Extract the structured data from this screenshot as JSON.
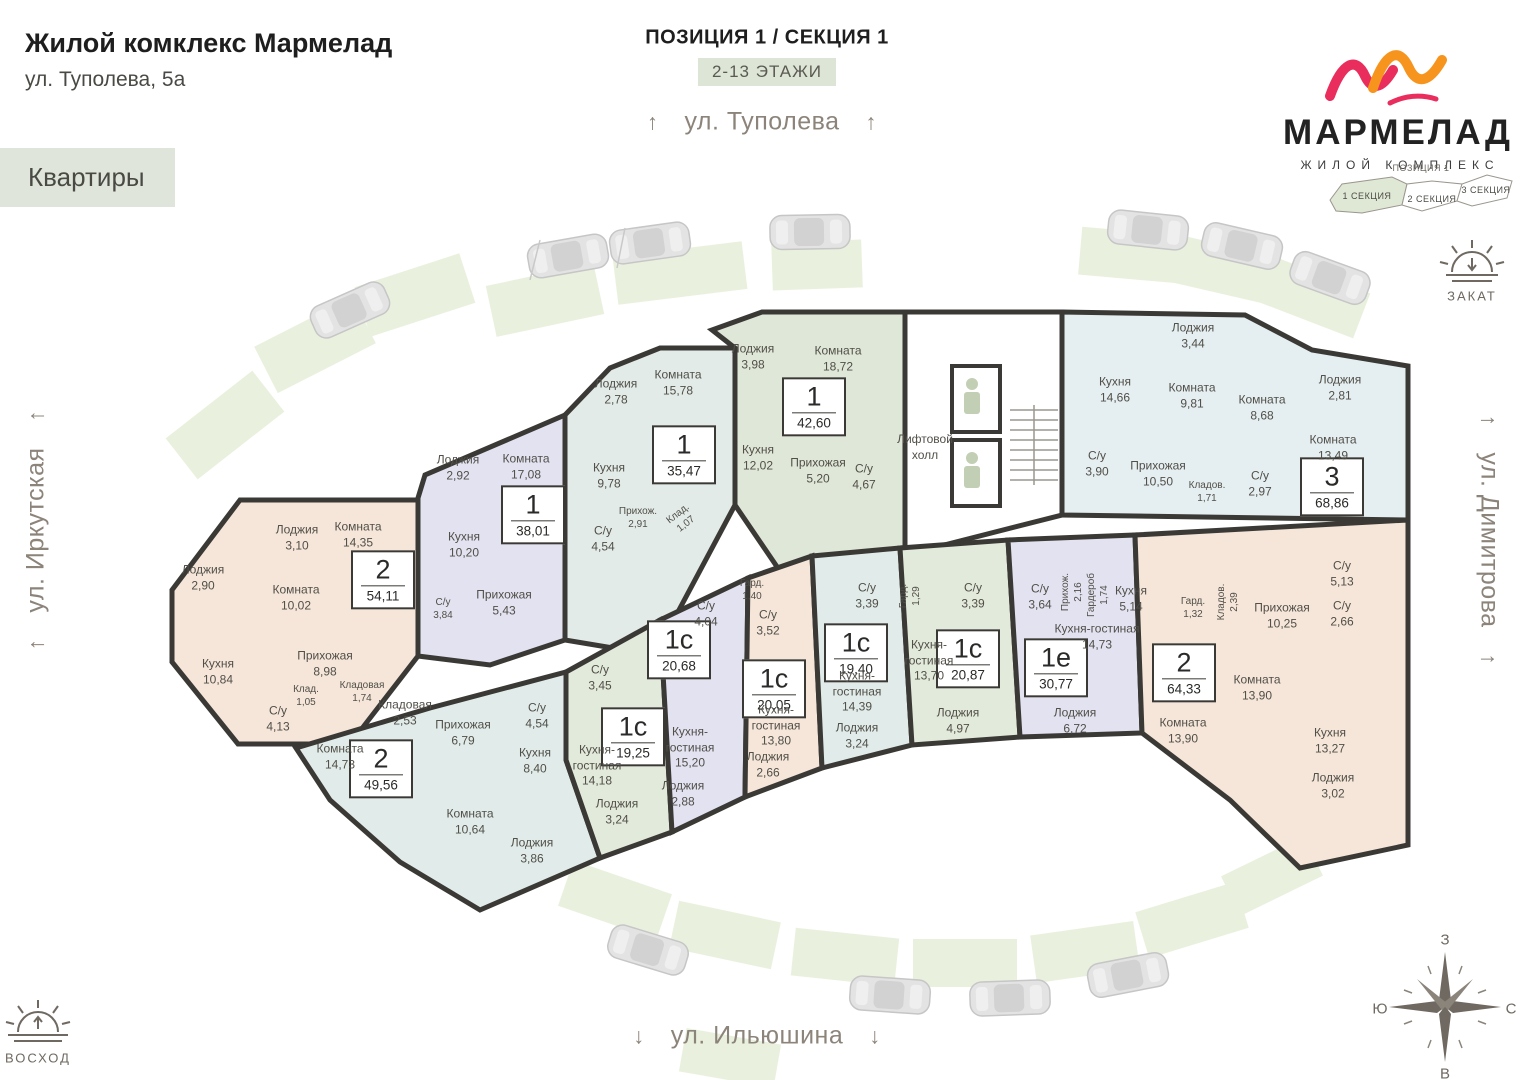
{
  "header": {
    "title": "Жилой комклекс Мармелад",
    "address": "ул. Туполева, 5а",
    "apartments_label": "Квартиры"
  },
  "plan": {
    "position_title": "ПОЗИЦИЯ 1 / СЕКЦИЯ 1",
    "floors_badge": "2-13 ЭТАЖИ",
    "elevator_hall": "Лифтовой холл"
  },
  "streets": {
    "top": "ул. Туполева",
    "left": "ул. Иркутская",
    "right": "ул. Димитрова",
    "bottom": "ул. Ильюшина",
    "arrow_up": "↑",
    "arrow_down": "↓"
  },
  "logo": {
    "title": "МАРМЕЛАД",
    "subtitle": "ЖИЛОЙ КОМПЛЕКС"
  },
  "minimap": {
    "position": "ПОЗИЦИЯ 1",
    "section1": "1 СЕКЦИЯ",
    "section2": "2 СЕКЦИЯ",
    "section3": "3 СЕКЦИЯ"
  },
  "sun": {
    "sunset": "ЗАКАТ",
    "sunrise": "ВОСХОД"
  },
  "compass": {
    "west": "З",
    "south": "Ю",
    "north": "С",
    "east": "В"
  },
  "palette": {
    "peach": "#f5e6d9",
    "lavender": "#e2e2f1",
    "teal": "#e2ebe8",
    "sage": "#dfe7d8",
    "lightblue": "#e5eef0",
    "bluegreen": "#e1ecea",
    "green": "#e2eadb",
    "parking": "#e9f1de",
    "wall": "#3b3935",
    "car": "#e2e2e2",
    "accent_pink": "#e92d5d",
    "accent_orange": "#f7941d",
    "minimap_section": "#dfe7d5",
    "white": "#ffffff"
  },
  "apartments": [
    {
      "type": "2",
      "area": "54,11",
      "rooms": [
        {
          "name": "Лоджия",
          "area": "2,90"
        },
        {
          "name": "Лоджия",
          "area": "3,10"
        },
        {
          "name": "Комната",
          "area": "14,35"
        },
        {
          "name": "Комната",
          "area": "10,02"
        },
        {
          "name": "Прихожая",
          "area": "8,98"
        },
        {
          "name": "Кухня",
          "area": "10,84"
        },
        {
          "name": "Клад.",
          "area": "1,05"
        },
        {
          "name": "Кладовая",
          "area": "1,74"
        },
        {
          "name": "С/у",
          "area": "4,13"
        }
      ]
    },
    {
      "type": "1",
      "area": "38,01",
      "rooms": [
        {
          "name": "Лоджия",
          "area": "2,92"
        },
        {
          "name": "Комната",
          "area": "17,08"
        },
        {
          "name": "Кухня",
          "area": "10,20"
        },
        {
          "name": "Прихожая",
          "area": "5,43"
        },
        {
          "name": "С/у",
          "area": "3,84"
        }
      ]
    },
    {
      "type": "1",
      "area": "35,47",
      "rooms": [
        {
          "name": "Лоджия",
          "area": "2,78"
        },
        {
          "name": "Комната",
          "area": "15,78"
        },
        {
          "name": "Кухня",
          "area": "9,78"
        },
        {
          "name": "Прихож.",
          "area": "2,91"
        },
        {
          "name": "С/у",
          "area": "4,54"
        },
        {
          "name": "Клад.",
          "area": "1,07"
        }
      ]
    },
    {
      "type": "1",
      "area": "42,60",
      "rooms": [
        {
          "name": "Лоджия",
          "area": "3,98"
        },
        {
          "name": "Комната",
          "area": "18,72"
        },
        {
          "name": "Кухня",
          "area": "12,02"
        },
        {
          "name": "Прихожая",
          "area": "5,20"
        },
        {
          "name": "С/у",
          "area": "4,67"
        }
      ]
    },
    {
      "type": "3",
      "area": "68,86",
      "rooms": [
        {
          "name": "Лоджия",
          "area": "3,44"
        },
        {
          "name": "Кухня",
          "area": "14,66"
        },
        {
          "name": "Комната",
          "area": "9,81"
        },
        {
          "name": "Комната",
          "area": "8,68"
        },
        {
          "name": "Лоджия",
          "area": "2,81"
        },
        {
          "name": "Комната",
          "area": "13,49"
        },
        {
          "name": "С/у",
          "area": "3,90"
        },
        {
          "name": "Прихожая",
          "area": "10,50"
        },
        {
          "name": "Кладов.",
          "area": "1,71"
        },
        {
          "name": "С/у",
          "area": "2,97"
        }
      ]
    },
    {
      "type": "2",
      "area": "49,56",
      "rooms": [
        {
          "name": "Комната",
          "area": "14,73"
        },
        {
          "name": "Кладовая",
          "area": "2,53"
        },
        {
          "name": "Прихожая",
          "area": "6,79"
        },
        {
          "name": "С/у",
          "area": "4,54"
        },
        {
          "name": "Кухня",
          "area": "8,40"
        },
        {
          "name": "Комната",
          "area": "10,64"
        },
        {
          "name": "Лоджия",
          "area": "3,86"
        }
      ]
    },
    {
      "type": "1с",
      "area": "19,25",
      "rooms": [
        {
          "name": "С/у",
          "area": "3,45"
        },
        {
          "name": "Кухня-гостиная",
          "area": "14,18"
        },
        {
          "name": "Лоджия",
          "area": "3,24"
        }
      ]
    },
    {
      "type": "1с",
      "area": "20,68",
      "rooms": [
        {
          "name": "С/у",
          "area": "4,04"
        },
        {
          "name": "Кухня-гостиная",
          "area": "15,20"
        },
        {
          "name": "Лоджия",
          "area": "2,88"
        }
      ]
    },
    {
      "type": "1с",
      "area": "20,05",
      "rooms": [
        {
          "name": "Гард.",
          "area": "1,40"
        },
        {
          "name": "С/у",
          "area": "3,52"
        },
        {
          "name": "Кухня-гостиная",
          "area": "13,80"
        },
        {
          "name": "Лоджия",
          "area": "2,66"
        }
      ]
    },
    {
      "type": "1с",
      "area": "19,40",
      "rooms": [
        {
          "name": "С/у",
          "area": "3,39"
        },
        {
          "name": "Кухня-гостиная",
          "area": "14,39"
        },
        {
          "name": "Лоджия",
          "area": "3,24"
        }
      ]
    },
    {
      "type": "1с",
      "area": "20,87",
      "rooms": [
        {
          "name": "Гард.",
          "area": "1,29"
        },
        {
          "name": "С/у",
          "area": "3,39"
        },
        {
          "name": "Кухня-гостиная",
          "area": "13,70"
        },
        {
          "name": "Лоджия",
          "area": "4,97"
        }
      ]
    },
    {
      "type": "1е",
      "area": "30,77",
      "rooms": [
        {
          "name": "С/у",
          "area": "3,64"
        },
        {
          "name": "Прихож.",
          "area": "2,16"
        },
        {
          "name": "Гардероб",
          "area": "1,74"
        },
        {
          "name": "Кухня",
          "area": "5,14"
        },
        {
          "name": "Кухня-гостиная",
          "area": "14,73"
        },
        {
          "name": "Лоджия",
          "area": "6,72"
        }
      ]
    },
    {
      "type": "2",
      "area": "64,33",
      "rooms": [
        {
          "name": "Гард.",
          "area": "1,32"
        },
        {
          "name": "Кладов.",
          "area": "2,39"
        },
        {
          "name": "Прихожая",
          "area": "10,25"
        },
        {
          "name": "С/у",
          "area": "5,13"
        },
        {
          "name": "С/у",
          "area": "2,66"
        },
        {
          "name": "Комната",
          "area": "13,90"
        },
        {
          "name": "Комната",
          "area": "13,90"
        },
        {
          "name": "Кухня",
          "area": "13,27"
        },
        {
          "name": "Лоджия",
          "area": "3,02"
        }
      ]
    }
  ]
}
